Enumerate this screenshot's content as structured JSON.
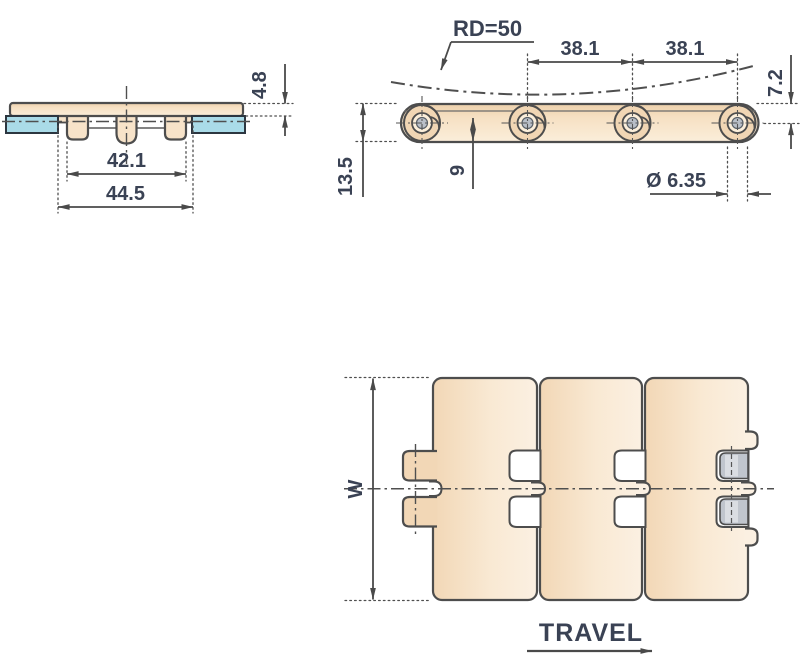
{
  "drawing": {
    "front_view": {
      "plate_thickness": "4.8",
      "hinge_width": "42.1",
      "overall_width": "44.5"
    },
    "side_view": {
      "back_flex_radius": "RD=50",
      "pitch_left": "38.1",
      "pitch_right": "38.1",
      "top_to_pin_center": "7.2",
      "chain_height": "13.5",
      "link_depth": "9",
      "pin_diameter": "Ø 6.35"
    },
    "top_view": {
      "width_label": "W",
      "travel_label": "TRAVEL"
    },
    "colors": {
      "plate_fill": "#f2d8b6",
      "plate_fill_light": "#fbeeda",
      "wear_strip_blue": "#aadbe8",
      "pin_gray": "#c0c5cd",
      "outline": "#4d4d4d",
      "dimension_text": "#3a4254",
      "background": "#ffffff"
    }
  }
}
